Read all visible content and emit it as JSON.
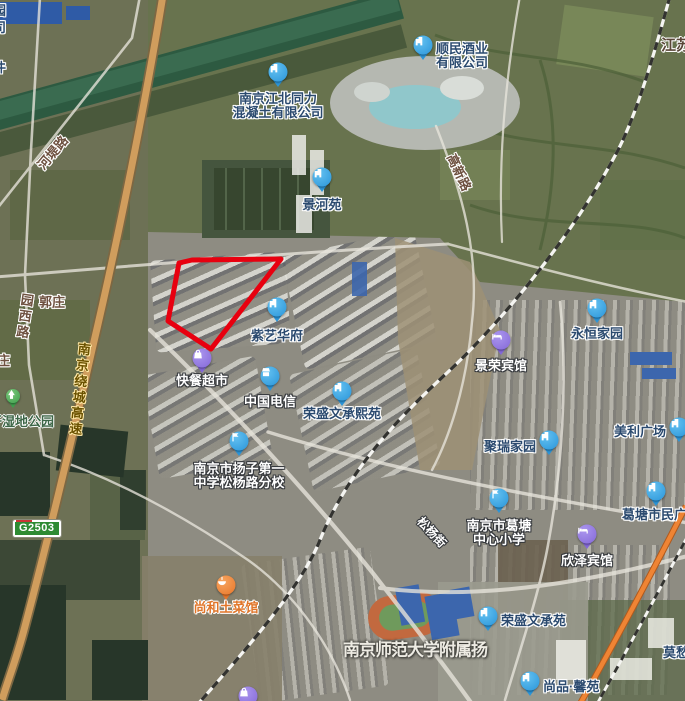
{
  "map": {
    "badge": {
      "text": "G2503"
    },
    "parcel_outline": {
      "color": "#e8000f",
      "points": "179,263 192,260 281,259 211,349 168,321"
    },
    "colors": {
      "marker_colors": {
        "blue": [
          "#63c1f1",
          "#2b95d9"
        ],
        "purple": [
          "#ab96ee",
          "#8468d8"
        ],
        "orange": [
          "#f7a55f",
          "#e8762a"
        ],
        "green": [
          "#7cc87c",
          "#3f9e4d"
        ]
      },
      "navy_text": "#2b4a6f",
      "white_text": "#ffffff",
      "orange_text": "#e0762a",
      "brown_text": "#6e5140",
      "green_text": "#3d6647",
      "highway_text": "#6b5200",
      "region_text": "#5a4638",
      "area_text": "#edebe3"
    },
    "pois": [
      {
        "id": "shunmin-liquor",
        "lines": [
          "顺民酒业",
          "有限公司"
        ],
        "x": 423,
        "y": 45,
        "marker": "blue",
        "icon": "building-icon",
        "label": "right",
        "dy": 10,
        "ts": "navy"
      },
      {
        "id": "tongli-concrete",
        "lines": [
          "南京江北同力",
          "混凝土有限公司"
        ],
        "x": 278,
        "y": 72,
        "marker": "blue",
        "icon": "building-icon",
        "label": "below",
        "dy": 4,
        "ts": "navy"
      },
      {
        "id": "jingheyuan",
        "lines": [
          "景河苑"
        ],
        "x": 322,
        "y": 177,
        "marker": "blue",
        "icon": "building-icon",
        "label": "below",
        "dy": 5,
        "ts": "navy"
      },
      {
        "id": "ziyi-huafu",
        "lines": [
          "紫艺华府"
        ],
        "x": 277,
        "y": 307,
        "marker": "blue",
        "icon": "building-icon",
        "label": "below",
        "dy": 6,
        "ts": "navy"
      },
      {
        "id": "kuaican-supermarket",
        "lines": [
          "快餐超市"
        ],
        "x": 202,
        "y": 358,
        "marker": "purple",
        "icon": "bag-icon",
        "label": "below",
        "dy": 0,
        "ts": "white"
      },
      {
        "id": "china-telecom",
        "lines": [
          "中国电信"
        ],
        "x": 270,
        "y": 376,
        "marker": "blue",
        "icon": "shop-icon",
        "label": "below",
        "dy": 3,
        "ts": "white"
      },
      {
        "id": "rongsheng-wenchengxiyuan",
        "lines": [
          "荣盛文承熙苑"
        ],
        "x": 342,
        "y": 391,
        "marker": "blue",
        "icon": "building-icon",
        "label": "below",
        "dy": 0,
        "ts": "navy"
      },
      {
        "id": "yangzi-no1-school",
        "lines": [
          "南京市扬子第一",
          "中学松杨路分校"
        ],
        "x": 239,
        "y": 441,
        "marker": "blue",
        "icon": "flag-icon",
        "label": "below",
        "dy": 5,
        "ts": "white"
      },
      {
        "id": "yongheng-jiayuan",
        "lines": [
          "永恒家园"
        ],
        "x": 597,
        "y": 308,
        "marker": "blue",
        "icon": "building-icon",
        "label": "below",
        "dy": 3,
        "ts": "navy"
      },
      {
        "id": "jingrong-hotel",
        "lines": [
          "景荣宾馆"
        ],
        "x": 501,
        "y": 340,
        "marker": "purple",
        "icon": "bed-icon",
        "label": "below",
        "dy": 3,
        "ts": "white"
      },
      {
        "id": "meili-plaza",
        "lines": [
          "美利广场"
        ],
        "x": 679,
        "y": 427,
        "marker": "blue",
        "icon": "building-icon",
        "label": "left",
        "dy": 4,
        "ts": "navy"
      },
      {
        "id": "jurui-jiayuan",
        "lines": [
          "聚瑞家园"
        ],
        "x": 549,
        "y": 440,
        "marker": "blue",
        "icon": "building-icon",
        "label": "left",
        "dy": 6,
        "ts": "navy"
      },
      {
        "id": "getang-primary-school",
        "lines": [
          "南京市葛塘",
          "中心小学"
        ],
        "x": 499,
        "y": 498,
        "marker": "blue",
        "icon": "flag-icon",
        "label": "below",
        "dy": 5,
        "ts": "white"
      },
      {
        "id": "xinze-hotel",
        "lines": [
          "欣泽宾馆"
        ],
        "x": 587,
        "y": 534,
        "marker": "purple",
        "icon": "bed-icon",
        "label": "below",
        "dy": 4,
        "ts": "white"
      },
      {
        "id": "getang-civic-plaza",
        "lines": [
          "葛塘市民广场"
        ],
        "x": 656,
        "y": 491,
        "marker": "blue",
        "icon": "building-icon",
        "label": "custom",
        "dx": -34,
        "dy": 25,
        "ts": "navy"
      },
      {
        "id": "rongsheng-wenchengyuan",
        "lines": [
          "荣盛文承苑"
        ],
        "x": 488,
        "y": 616,
        "marker": "blue",
        "icon": "building-icon",
        "label": "right",
        "dy": 4,
        "ts": "navy"
      },
      {
        "id": "shangpin-xinyuan",
        "lines": [
          "尚品·馨苑"
        ],
        "x": 530,
        "y": 681,
        "marker": "blue",
        "icon": "building-icon",
        "label": "right",
        "dy": 5,
        "ts": "navy"
      },
      {
        "id": "shanghe-restaurant",
        "lines": [
          "尚和土菜馆"
        ],
        "x": 226,
        "y": 585,
        "marker": "orange",
        "icon": "food-icon",
        "label": "below",
        "dy": 0,
        "ts": "orange"
      },
      {
        "id": "wetland-park",
        "lines": [],
        "x": 13,
        "y": 396,
        "marker": "green",
        "icon": "tree-icon",
        "label": "none",
        "small": true
      },
      {
        "id": "south-shopping",
        "lines": [],
        "x": 248,
        "y": 696,
        "marker": "purple",
        "icon": "bag-icon",
        "label": "none"
      }
    ],
    "labels": [
      {
        "text": "河堤路",
        "x": 52,
        "y": 152,
        "style": "brown",
        "rotate": -50
      },
      {
        "text": "园西路",
        "x": 24,
        "y": 317,
        "style": "brown",
        "vertical": true,
        "rotate": 8
      },
      {
        "text": "郭庄",
        "x": 52,
        "y": 301,
        "style": "brown"
      },
      {
        "text": "庄",
        "x": -3,
        "y": 358,
        "style": "brown",
        "anchor": "left"
      },
      {
        "text": "开湿地公园",
        "x": -11,
        "y": 419,
        "style": "green",
        "anchor": "left"
      },
      {
        "text": "高新路",
        "x": 460,
        "y": 172,
        "style": "brown",
        "rotate": 65
      },
      {
        "text": "松杨街",
        "x": 432,
        "y": 532,
        "style": "white",
        "rotate": 47,
        "size": 12
      },
      {
        "text": "南京绕城高速",
        "x": 79,
        "y": 390,
        "style": "highway",
        "vertical": true,
        "rotate": 6
      },
      {
        "text": "江苏",
        "x": 661,
        "y": 42,
        "style": "region",
        "anchor": "left",
        "size": 15
      },
      {
        "text": "莫愁",
        "x": 663,
        "y": 650,
        "style": "navy",
        "anchor": "left"
      },
      {
        "text": "南京师范大学附属扬",
        "x": 415,
        "y": 648,
        "style": "big",
        "size": 17
      },
      {
        "text": "园",
        "x": -7,
        "y": 8,
        "style": "navy",
        "anchor": "left"
      },
      {
        "text": "司",
        "x": -7,
        "y": 25,
        "style": "navy",
        "anchor": "left"
      },
      {
        "text": "件",
        "x": -7,
        "y": 65,
        "style": "navy",
        "anchor": "left"
      }
    ]
  }
}
